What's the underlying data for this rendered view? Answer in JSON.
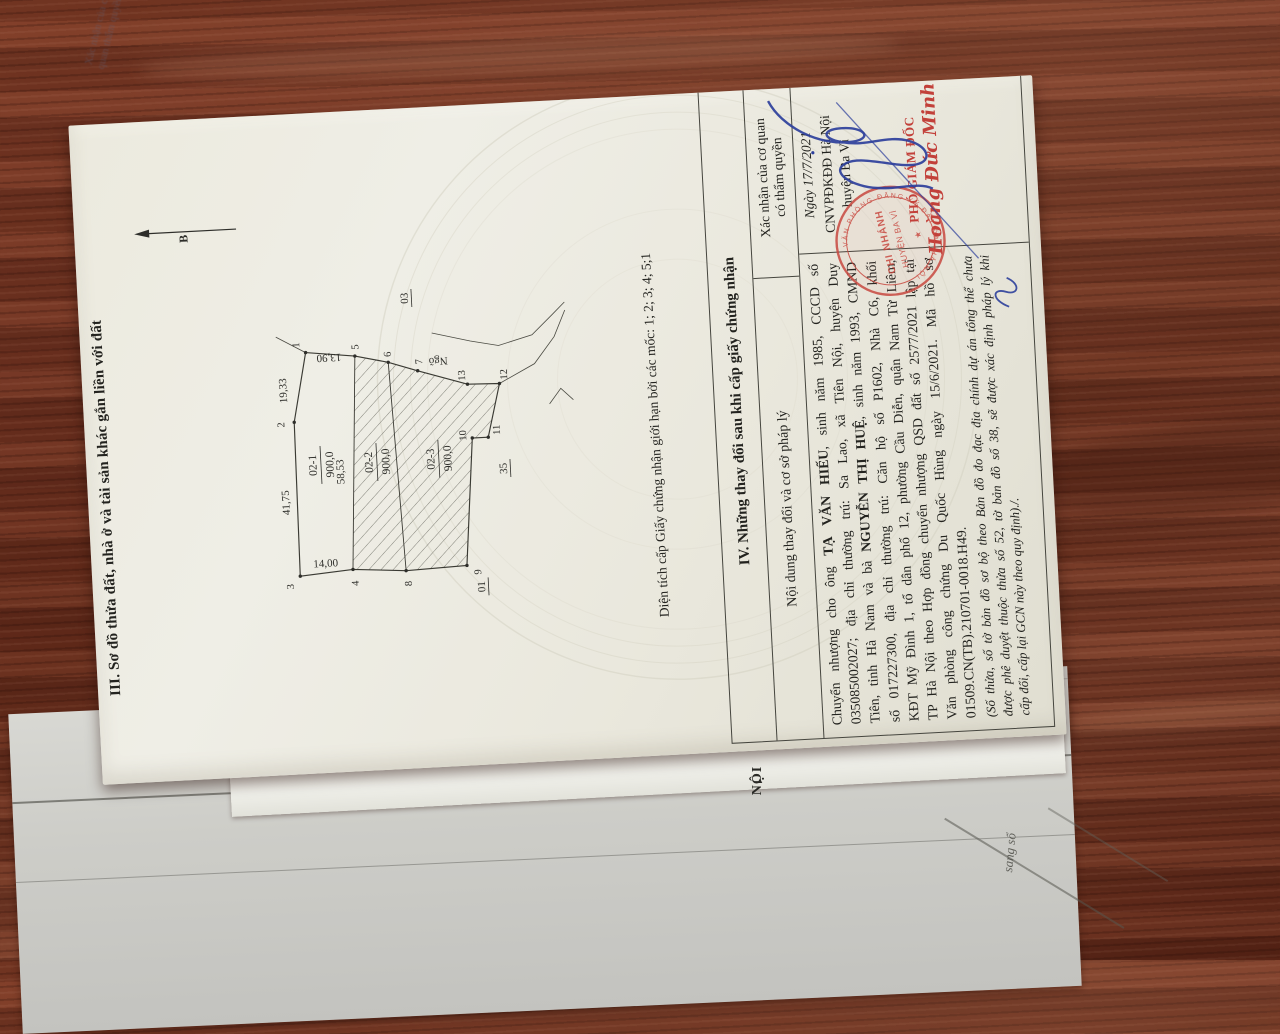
{
  "colors": {
    "wood": "#6e3322",
    "paper": "#edece3",
    "stamp_red": "#c8483f",
    "signature_blue": "#2c3f9b",
    "ink": "#23231f"
  },
  "document": {
    "section3_title": "III. Sơ đồ thửa đất, nhà ở và tài sản khác gắn liền với đất",
    "north_label": "B",
    "caption": "Diện tích cấp Giấy chứng nhận giới hạn bởi các mốc: 1; 2; 3; 4; 5;1",
    "diagram": {
      "type": "cadastral-sketch",
      "points": [
        {
          "n": "1",
          "px": 421,
          "py": 225,
          "lx": 429,
          "ly": 219
        },
        {
          "n": "2",
          "px": 352,
          "py": 210,
          "lx": 350,
          "ly": 200
        },
        {
          "n": "3",
          "px": 198,
          "py": 208,
          "lx": 188,
          "ly": 201
        },
        {
          "n": "4",
          "px": 202,
          "py": 261,
          "lx": 188,
          "ly": 266
        },
        {
          "n": "5",
          "px": 415,
          "py": 274,
          "lx": 424,
          "ly": 278
        },
        {
          "n": "6",
          "px": 407,
          "py": 307,
          "lx": 415,
          "ly": 310
        },
        {
          "n": "7",
          "px": 397,
          "py": 336,
          "lx": 406,
          "ly": 341
        },
        {
          "n": "8",
          "px": 198,
          "py": 314,
          "lx": 185,
          "ly": 319
        },
        {
          "n": "9",
          "px": 200,
          "py": 375,
          "lx": 193,
          "ly": 389
        },
        {
          "n": "10",
          "px": 327,
          "py": 387,
          "lx": 330,
          "ly": 381
        },
        {
          "n": "11",
          "px": 327,
          "py": 403,
          "lx": 334,
          "ly": 415
        },
        {
          "n": "12",
          "px": 380,
          "py": 417,
          "lx": 389,
          "ly": 425
        },
        {
          "n": "13",
          "px": 381,
          "py": 385,
          "lx": 390,
          "ly": 383
        }
      ],
      "parcels": [
        {
          "id": "02-1",
          "area": "900,0",
          "x": 308,
          "y": 230
        },
        {
          "id": "02-2",
          "area": "900,0",
          "x": 308,
          "y": 286
        },
        {
          "id": "02-3",
          "area": "900,0",
          "x": 308,
          "y": 348
        }
      ],
      "dims": [
        {
          "text": "19,33",
          "x": 384,
          "y": 204,
          "rot": 0
        },
        {
          "text": "41,75",
          "x": 272,
          "y": 201,
          "rot": 0
        },
        {
          "text": "13,90",
          "x": 418,
          "y": 248,
          "rot": -90
        },
        {
          "text": "14,00",
          "x": 206,
          "y": 234,
          "rot": 90
        },
        {
          "text": "58,53",
          "x": 300,
          "y": 257,
          "rot": 0
        }
      ],
      "adjacent": [
        {
          "text": "35",
          "x": 295,
          "y": 420,
          "u": true
        },
        {
          "text": "01",
          "x": 178,
          "y": 392,
          "u": true
        },
        {
          "text": "03",
          "x": 470,
          "y": 330,
          "u": true
        },
        {
          "text": "Ngõ",
          "x": 409,
          "y": 357,
          "rot": -90
        }
      ]
    },
    "section4": {
      "title": "IV. Những thay đổi sau khi cấp giấy chứng nhận",
      "col1_header": "Nội dung thay đổi và cơ sở pháp lý",
      "col2_header_line1": "Xác nhận của cơ quan",
      "col2_header_line2": "có thẩm quyền",
      "body_lines": [
        [
          {
            "t": "Chuyển nhượng cho ông "
          },
          {
            "t": "TẠ VĂN HIẾU",
            "b": 1
          },
          {
            "t": ", sinh năm 1985, CCCD số"
          }
        ],
        [
          {
            "t": "035085002027; địa chỉ thường trú: Sa Lao, xã Tiên Nội, huyện Duy"
          }
        ],
        [
          {
            "t": "Tiên, tỉnh Hà Nam và bà "
          },
          {
            "t": "NGUYỄN THỊ HUỆ",
            "b": 1
          },
          {
            "t": ", sinh năm 1993, CMND"
          }
        ],
        [
          {
            "t": "số 017227300, địa chỉ thường trú: Căn hộ số P1602, Nhà C6, khối"
          }
        ],
        [
          {
            "t": "KĐT Mỹ Đình 1, tổ dân phố 12, phường Cầu Diễn, quận Nam Từ Liêm,"
          }
        ],
        [
          {
            "t": "TP Hà Nội theo Hợp đồng chuyển nhượng QSD đất số 2577/2021 lập tại"
          }
        ],
        [
          {
            "t": "Văn phòng công chứng Du Quốc Hùng ngày 15/6/2021. Mã hồ sơ"
          }
        ],
        [
          {
            "t": "01509.CN(TB).210701-0018.H49."
          }
        ]
      ],
      "note_lines": [
        "(Số thửa, số tờ bản đồ sơ bộ theo Bản đồ đo đạc địa chính dự án tổng thể chưa",
        "được phê duyệt thuộc thửa số 52, tờ bản đồ số 38, sẽ được xác định pháp lý khi",
        "cấp đổi, cấp lại GCN này theo quy định)./."
      ],
      "approval": {
        "date": "Ngày 17/7/2021",
        "office_line1": "CNVPĐKĐĐ Hà Nội",
        "office_line2": "huyện Ba Vì",
        "signer_title": "PHÓ GIÁM ĐỐC",
        "signer_name": "Hoàng Đức Minh",
        "stamp_center_line1": "CHI NHÁNH",
        "stamp_center_line2": "HUYỆN BA VÌ",
        "stamp_ring_text": "VĂN PHÒNG ĐĂNG KÝ ĐẤT ĐAI HÀ NỘI"
      }
    },
    "under_pages": {
      "peek_text": "NỘI",
      "faint_text_line1": "Xác nhận của cơ",
      "faint_text_line2": "quan thẩm quyền",
      "corner_text": "sang sổ"
    }
  }
}
